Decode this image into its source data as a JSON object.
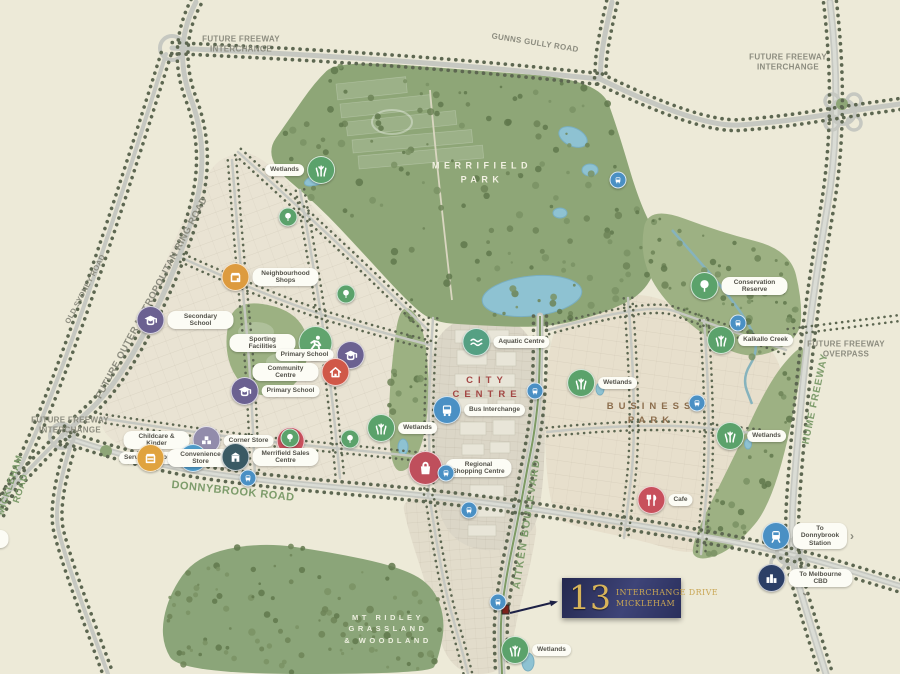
{
  "map": {
    "colors": {
      "background": "#edead8",
      "label_grey": "#8c8c7f",
      "label_green": "#7d9c6b",
      "water": "#8ec2d2",
      "park_green": "#8ea677",
      "callout_navy": "#262a52",
      "callout_gold": "#d2ae55",
      "marker_red": "#7c241c"
    },
    "road_labels": [
      {
        "id": "future-freeway-interchange-nw",
        "lines": [
          "FUTURE FREEWAY",
          "INTERCHANGE"
        ],
        "x": 241,
        "y": 44,
        "rot": 0,
        "color": "grey",
        "size": 8,
        "spacing": 0.3
      },
      {
        "id": "gunns-gully-road",
        "lines": [
          "GUNNS GULLY ROAD"
        ],
        "x": 535,
        "y": 43,
        "rot": 9,
        "color": "grey",
        "size": 8,
        "spacing": 0.3
      },
      {
        "id": "future-freeway-interchange-ne",
        "lines": [
          "FUTURE FREEWAY",
          "INTERCHANGE"
        ],
        "x": 788,
        "y": 62,
        "rot": 0,
        "color": "grey",
        "size": 8,
        "spacing": 0.3
      },
      {
        "id": "old-sydney-road",
        "lines": [
          "OLD SYDNEY ROAD"
        ],
        "x": 85,
        "y": 289,
        "rot": -62,
        "color": "grey",
        "size": 7.5,
        "spacing": 0.3
      },
      {
        "id": "future-outer-metropolitan-ring-road",
        "lines": [
          "FUTURE OUTER METROPOLITAN RING ROAD"
        ],
        "x": 152,
        "y": 298,
        "rot": -62,
        "color": "grey",
        "size": 9.5,
        "spacing": 0.5
      },
      {
        "id": "future-freeway-overpass",
        "lines": [
          "FUTURE FREEWAY",
          "OVERPASS"
        ],
        "x": 846,
        "y": 349,
        "rot": 0,
        "color": "grey",
        "size": 8,
        "spacing": 0.3
      },
      {
        "id": "hume-freeway",
        "lines": [
          "HUME FREEWAY"
        ],
        "x": 816,
        "y": 399,
        "rot": -78,
        "color": "green",
        "size": 10,
        "spacing": 1
      },
      {
        "id": "future-freeway-interchange-sw",
        "lines": [
          "FUTURE FREEWAY",
          "INTERCHANGE"
        ],
        "x": 70,
        "y": 425,
        "rot": 0,
        "color": "grey",
        "size": 8,
        "spacing": 0.3
      },
      {
        "id": "mickleham-road",
        "lines": [
          "MICKLEHAM",
          "ROAD"
        ],
        "x": 16,
        "y": 487,
        "rot": -72,
        "color": "green",
        "size": 9.5,
        "spacing": 0.5
      },
      {
        "id": "donnybrook-road",
        "lines": [
          "DONNYBROOK ROAD"
        ],
        "x": 233,
        "y": 492,
        "rot": 6,
        "color": "green",
        "size": 11,
        "spacing": 0.5
      },
      {
        "id": "aitken-boulevard",
        "lines": [
          "AITKEN BOULEVARD"
        ],
        "x": 527,
        "y": 524,
        "rot": -81,
        "color": "green",
        "size": 10.5,
        "spacing": 1.5
      }
    ],
    "area_labels": [
      {
        "id": "merrifield-park",
        "lines": [
          "MERRIFIELD",
          "PARK"
        ],
        "x": 482,
        "y": 173,
        "color": "#f2f1e2",
        "size": 9,
        "spacing": 4.5
      },
      {
        "id": "city-centre",
        "lines": [
          "CITY",
          "CENTRE"
        ],
        "x": 487,
        "y": 388,
        "color": "#a34744",
        "size": 9.5,
        "spacing": 5
      },
      {
        "id": "business-park",
        "lines": [
          "BUSINESS",
          "PARK"
        ],
        "x": 651,
        "y": 414,
        "color": "#8c6e4d",
        "size": 9.5,
        "spacing": 5
      },
      {
        "id": "mt-ridley",
        "lines": [
          "MT RIDLEY",
          "GRASSLAND",
          "& WOODLAND"
        ],
        "x": 388,
        "y": 629,
        "color": "#eef0e0",
        "size": 7.5,
        "spacing": 3.5
      }
    ],
    "badges": [
      {
        "id": "wetlands-nw",
        "icon": "reeds",
        "label": "Wetlands",
        "side": "left",
        "x": 300,
        "y": 170,
        "color": "#5ba26b"
      },
      {
        "id": "park-tree-1",
        "icon": "tree",
        "label": "",
        "x": 288,
        "y": 217,
        "color": "#5ba26b",
        "size": "small"
      },
      {
        "id": "neighbourhood-shops",
        "icon": "shop",
        "label": "Neighbourhood Shops",
        "side": "right",
        "x": 270,
        "y": 277,
        "color": "#dd9b3f"
      },
      {
        "id": "secondary-school",
        "icon": "school",
        "label": "Secondary School",
        "side": "right",
        "x": 185,
        "y": 320,
        "color": "#6b6191"
      },
      {
        "id": "park-tree-2",
        "icon": "tree",
        "label": "",
        "x": 346,
        "y": 294,
        "color": "#5ba26b",
        "size": "small"
      },
      {
        "id": "sporting-facilities",
        "icon": "sport",
        "label": "Sporting Facilities",
        "side": "left",
        "x": 281,
        "y": 343,
        "color": "#61a46e",
        "size": "big"
      },
      {
        "id": "primary-school-1",
        "icon": "school",
        "label": "Primary School",
        "side": "left",
        "x": 320,
        "y": 355,
        "color": "#6b6191"
      },
      {
        "id": "community-centre",
        "icon": "community",
        "label": "Community Centre",
        "side": "left",
        "x": 301,
        "y": 372,
        "color": "#d05848"
      },
      {
        "id": "primary-school-2",
        "icon": "school",
        "label": "Primary School",
        "side": "right",
        "x": 275,
        "y": 391,
        "color": "#6b6191"
      },
      {
        "id": "childcare-kinder",
        "icon": "childcare",
        "label": "Childcare & Kinder",
        "side": "left",
        "x": 172,
        "y": 440,
        "color": "#928cab"
      },
      {
        "id": "service-station",
        "icon": "fuel",
        "label": "Service Station",
        "side": "left",
        "x": 163,
        "y": 458,
        "color": "#4f9bc8"
      },
      {
        "id": "convenience-store",
        "icon": "store",
        "label": "Convenience Store",
        "side": "right",
        "x": 185,
        "y": 458,
        "color": "#e0a33f"
      },
      {
        "id": "corner-store",
        "icon": "store",
        "label": "Corner Store",
        "side": "left",
        "x": 264,
        "y": 441,
        "color": "#c8505c"
      },
      {
        "id": "merrifield-sales-centre",
        "icon": "building",
        "label": "Merrifield Sales Centre",
        "side": "right",
        "x": 270,
        "y": 457,
        "color": "#3a5a64"
      },
      {
        "id": "park-tree-3",
        "icon": "tree",
        "label": "",
        "x": 290,
        "y": 438,
        "color": "#5ba26b",
        "size": "small"
      },
      {
        "id": "park-tree-4",
        "icon": "tree",
        "label": "",
        "x": 350,
        "y": 439,
        "color": "#5ba26b",
        "size": "small"
      },
      {
        "id": "aquatic-centre",
        "icon": "waves",
        "label": "Aquatic Centre",
        "side": "right",
        "x": 506,
        "y": 342,
        "color": "#55a083"
      },
      {
        "id": "bus-interchange",
        "icon": "bus",
        "label": "Bus Interchange",
        "side": "right",
        "x": 479,
        "y": 410,
        "color": "#4a90c4"
      },
      {
        "id": "wetlands-city",
        "icon": "reeds",
        "label": "Wetlands",
        "side": "right",
        "x": 402,
        "y": 428,
        "color": "#5ba26b"
      },
      {
        "id": "regional-shopping-centre",
        "icon": "bag",
        "label": "Regional Shopping Centre",
        "side": "right",
        "x": 460,
        "y": 468,
        "color": "#bf4f5c",
        "size": "big"
      },
      {
        "id": "conservation-reserve",
        "icon": "tree",
        "label": "Conservation Reserve",
        "side": "right",
        "x": 739,
        "y": 286,
        "color": "#5ba26b"
      },
      {
        "id": "kalkallo-creek",
        "icon": "reeds",
        "label": "Kalkallo Creek",
        "side": "right",
        "x": 750,
        "y": 340,
        "color": "#5ba26b"
      },
      {
        "id": "wetlands-business-nw",
        "icon": "reeds",
        "label": "Wetlands",
        "side": "right",
        "x": 602,
        "y": 383,
        "color": "#5ba26b"
      },
      {
        "id": "wetlands-business-se",
        "icon": "reeds",
        "label": "Wetlands",
        "side": "right",
        "x": 751,
        "y": 436,
        "color": "#5ba26b"
      },
      {
        "id": "cafe",
        "icon": "dining",
        "label": "Cafe",
        "side": "right",
        "x": 665,
        "y": 500,
        "color": "#c8505c"
      },
      {
        "id": "to-donnybrook-station",
        "icon": "train",
        "label": "To Donnybrook Station",
        "side": "right",
        "x": 808,
        "y": 536,
        "color": "#4a90c4",
        "chevron": "right"
      },
      {
        "id": "to-melbourne-cbd",
        "icon": "city",
        "label": "To Melbourne CBD",
        "side": "right",
        "x": 805,
        "y": 578,
        "color": "#2c3f66",
        "chevron": "down"
      },
      {
        "id": "to-melbourne-airport",
        "icon": "plane",
        "label": "To Melbourne Airport",
        "side": "right",
        "x": -40,
        "y": 539,
        "color": "#4a90c4"
      },
      {
        "id": "wetlands-south",
        "icon": "reeds",
        "label": "Wetlands",
        "side": "right",
        "x": 536,
        "y": 650,
        "color": "#5ba26b"
      }
    ],
    "bus_stops": [
      [
        248,
        478
      ],
      [
        446,
        473
      ],
      [
        469,
        510
      ],
      [
        535,
        391
      ],
      [
        697,
        403
      ],
      [
        738,
        323
      ],
      [
        498,
        602
      ],
      [
        618,
        180
      ]
    ],
    "marker": {
      "x": 502,
      "y": 605
    },
    "callout": {
      "number": "13",
      "line1": "INTERCHANGE DRIVE",
      "line2": "MICKLEHAM"
    }
  }
}
